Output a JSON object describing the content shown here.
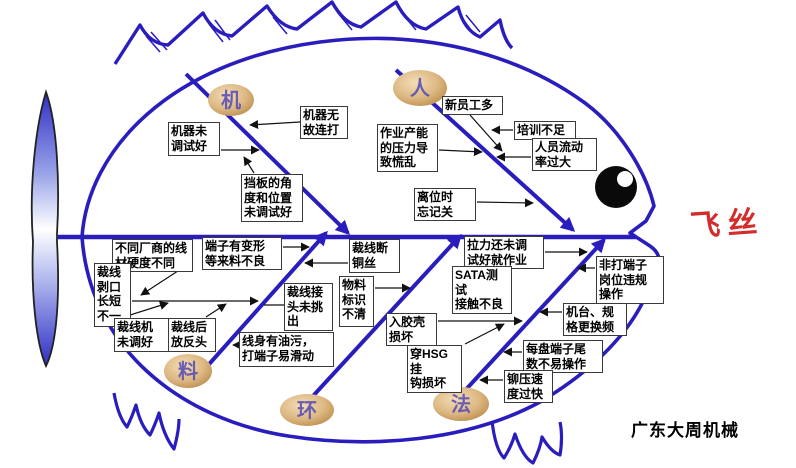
{
  "problem": {
    "label": "飞丝"
  },
  "watermark": "广东大周机械",
  "categories": [
    {
      "id": "ji",
      "label": "机"
    },
    {
      "id": "ren",
      "label": "人"
    },
    {
      "id": "liao",
      "label": "料"
    },
    {
      "id": "huan",
      "label": "环"
    },
    {
      "id": "fa",
      "label": "法"
    }
  ],
  "causes": [
    {
      "id": "jiqi-wugu",
      "category": "机",
      "label": "机器无\n故连打"
    },
    {
      "id": "jiqi-wei",
      "category": "机",
      "label": "机器未\n调试好"
    },
    {
      "id": "dangban",
      "category": "机",
      "label": "挡板的角\n度和位置\n未调试好"
    },
    {
      "id": "xin-yuangong",
      "category": "人",
      "label": "新员工多"
    },
    {
      "id": "peixun",
      "category": "人",
      "label": "培训不足"
    },
    {
      "id": "renyuan-liudong",
      "category": "人",
      "label": "人员流动\n率过大"
    },
    {
      "id": "zuoye-channeng",
      "category": "人",
      "label": "作业产能\n的压力导\n致慌乱"
    },
    {
      "id": "liwei",
      "category": "人",
      "label": "离位时\n忘记关"
    },
    {
      "id": "butong-changshang",
      "category": "料",
      "label": "不同厂商的线\n材硬度不同"
    },
    {
      "id": "caixian-bokou",
      "category": "料",
      "label": "裁线\n剥口\n长短\n不一"
    },
    {
      "id": "caixianji",
      "category": "料",
      "label": "裁线机\n未调好"
    },
    {
      "id": "caixianhou",
      "category": "料",
      "label": "裁线后\n放反头"
    },
    {
      "id": "duanzi-bianxing",
      "category": "料",
      "label": "端子有变形\n等来料不良"
    },
    {
      "id": "caixian-duan",
      "category": "料",
      "label": "裁线断\n铜丝"
    },
    {
      "id": "caixian-jietou",
      "category": "料",
      "label": "裁线接\n头未挑\n出"
    },
    {
      "id": "xianshen-youwu",
      "category": "料",
      "label": "线身有油污，\n打端子易滑动"
    },
    {
      "id": "wuliao-biaoshi",
      "category": "环",
      "label": "物料\n标识\n不清"
    },
    {
      "id": "lali",
      "category": "法",
      "label": "拉力还未调\n试好就作业"
    },
    {
      "id": "sata",
      "category": "法",
      "label": "SATA测试\n接触不良"
    },
    {
      "id": "rujiaoqiao",
      "category": "法",
      "label": "入胶壳\n损坏"
    },
    {
      "id": "chuan-hsg",
      "category": "法",
      "label": "穿HSG挂\n钩损坏"
    },
    {
      "id": "feida-duanzi",
      "category": "法",
      "label": "非打端子\n岗位违规\n操作"
    },
    {
      "id": "jitai-guige",
      "category": "法",
      "label": "机台、规\n格更换频"
    },
    {
      "id": "meipan-duanzi",
      "category": "法",
      "label": "每盘端子尾\n数不易操作"
    },
    {
      "id": "maoya-sudu",
      "category": "法",
      "label": "铆压速\n度过快"
    }
  ],
  "colors": {
    "bone": "#2a1dbe",
    "arrow": "#111111",
    "problem_text": "#d42b2b",
    "oval_fill": "#dcb781",
    "oval_text": "#5c50b4"
  }
}
